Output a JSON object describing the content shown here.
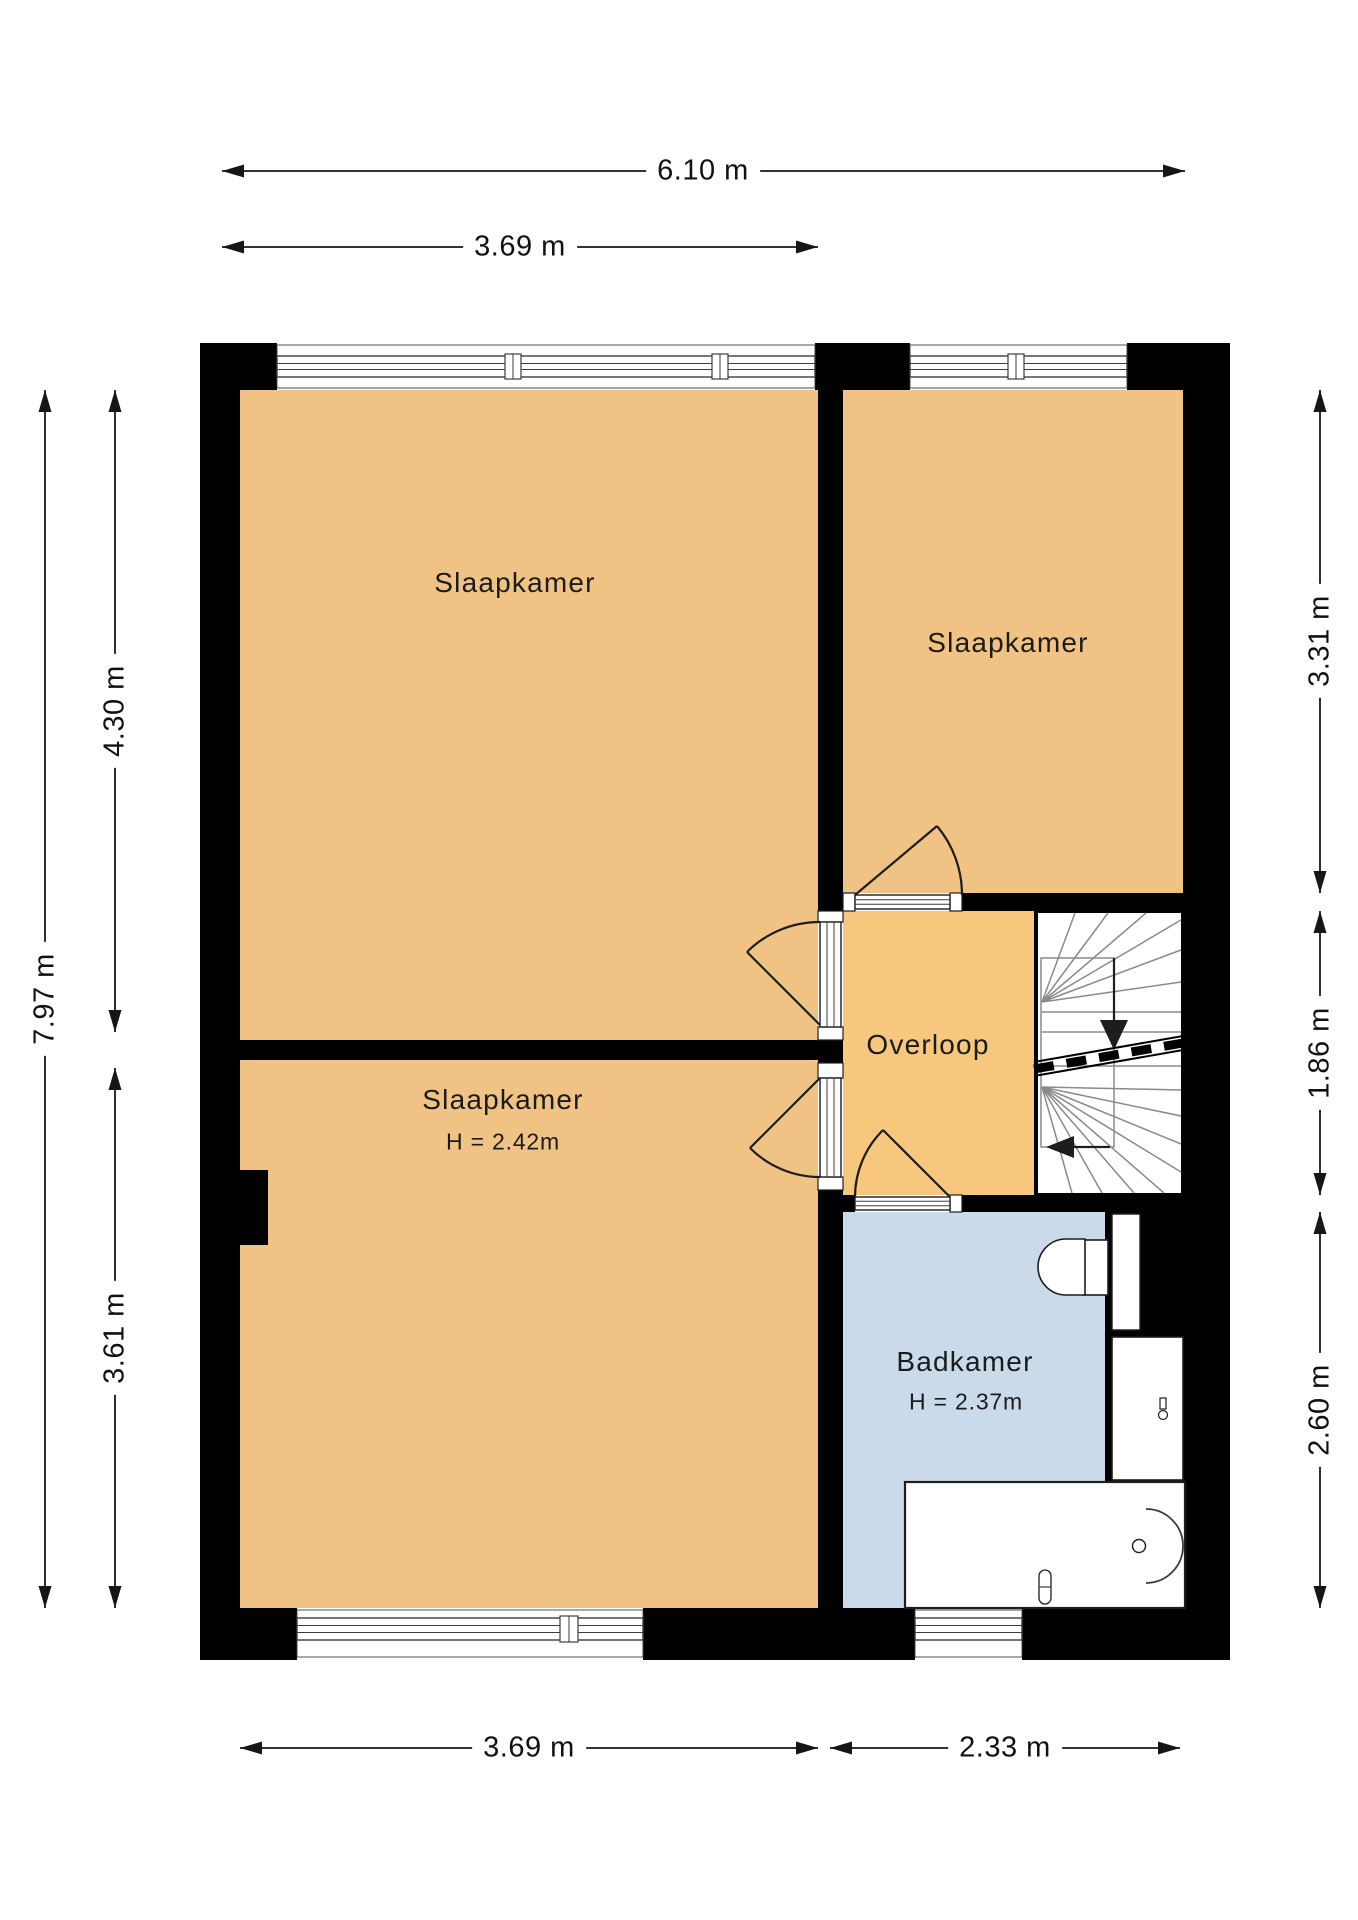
{
  "title": "Verdieping plattegrond",
  "colors": {
    "background": "#FFFFFF",
    "wall": "#000000",
    "bedroom_fill": "#F0C384",
    "hall_fill": "#F6C77D",
    "bathroom_fill": "#CBDAEA",
    "stair_line": "#8A8A8A",
    "dimension_line": "#161616"
  },
  "rooms": [
    {
      "id": "bedroom-top-left",
      "label": "Slaapkamer"
    },
    {
      "id": "bedroom-top-right",
      "label": "Slaapkamer"
    },
    {
      "id": "bedroom-bottom-left",
      "label": "Slaapkamer",
      "height_note": "H = 2.42m"
    },
    {
      "id": "landing",
      "label": "Overloop"
    },
    {
      "id": "bathroom",
      "label": "Badkamer",
      "height_note": "H = 2.37m"
    }
  ],
  "fixtures": [
    "stairs",
    "toilet",
    "duct",
    "washbasin",
    "bathtub"
  ],
  "dimensions": {
    "top": [
      "6.10 m",
      "3.69 m"
    ],
    "left": [
      "7.97 m",
      "4.30 m",
      "3.61 m"
    ],
    "right": [
      "3.31 m",
      "1.86 m",
      "2.60 m"
    ],
    "bottom": [
      "3.69 m",
      "2.33 m"
    ]
  }
}
